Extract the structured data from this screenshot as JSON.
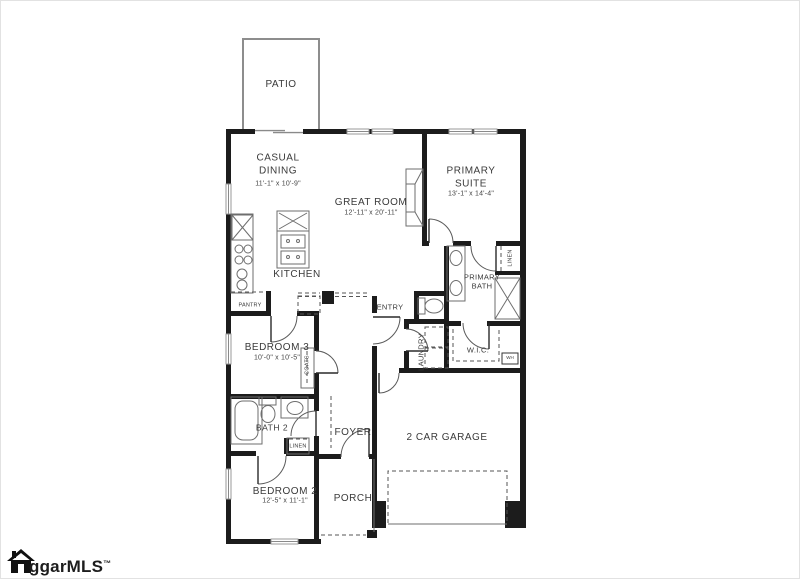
{
  "plan": {
    "patio": {
      "label": "PATIO"
    },
    "casual_dining": {
      "label": "CASUAL DINING",
      "dims": "11'-1\" x 10'-9\""
    },
    "great_room": {
      "label": "GREAT ROOM",
      "dims": "12'-11\" x 20'-11\""
    },
    "primary_suite": {
      "label": "PRIMARY SUITE",
      "dims": "13'-1\" x 14'-4\""
    },
    "kitchen": {
      "label": "KITCHEN"
    },
    "pantry": {
      "label": "PANTRY"
    },
    "primary_bath": {
      "label": "PRIMARY BATH"
    },
    "linen_primary": {
      "label": "LINEN"
    },
    "wic": {
      "label": "W.I.C."
    },
    "water_heater": {
      "label": "WH"
    },
    "entry": {
      "label": "ENTRY"
    },
    "laundry": {
      "label": "LAUNDRY"
    },
    "bedroom_3": {
      "label": "BEDROOM 3",
      "dims": "10'-0\" x 10'-5\""
    },
    "coats": {
      "label": "COATS"
    },
    "bath_2": {
      "label": "BATH 2"
    },
    "linen_hall": {
      "label": "LINEN"
    },
    "foyer": {
      "label": "FOYER"
    },
    "bedroom_2": {
      "label": "BEDROOM 2",
      "dims": "12'-5\" x 11'-1\""
    },
    "porch": {
      "label": "PORCH"
    },
    "garage": {
      "label": "2 CAR GARAGE"
    }
  },
  "watermark": {
    "brand": "ggarMLS",
    "tm": "™"
  },
  "colors": {
    "wall": "#1c1c1c",
    "fixture": "#6e6e6e",
    "patio": "#8d8d8d"
  }
}
